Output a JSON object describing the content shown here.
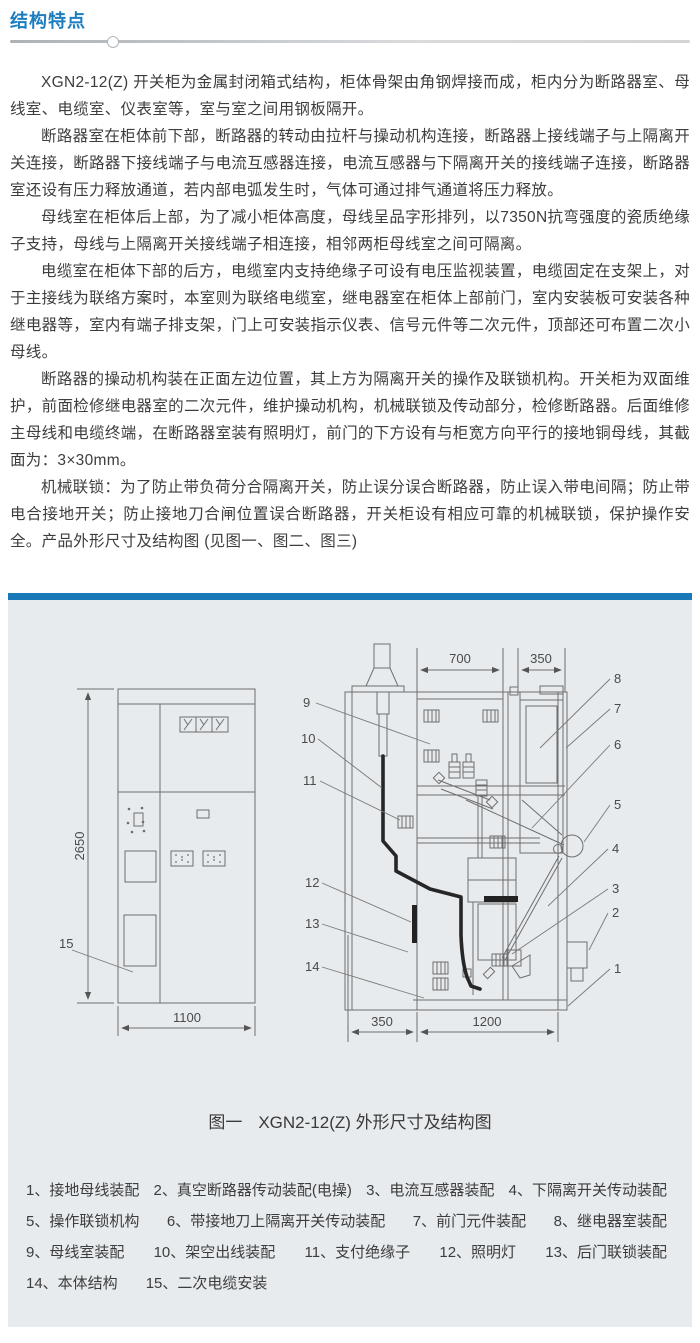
{
  "header": {
    "title": "结构特点"
  },
  "content": {
    "paragraphs": [
      "XGN2-12(Z) 开关柜为金属封闭箱式结构，柜体骨架由角钢焊接而成，柜内分为断路器室、母线室、电缆室、仪表室等，室与室之间用钢板隔开。",
      "断路器室在柜体前下部，断路器的转动由拉杆与操动机构连接，断路器上接线端子与上隔离开关连接，断路器下接线端子与电流互感器连接，电流互感器与下隔离开关的接线端子连接，断路器室还设有压力释放通道，若内部电弧发生时，气体可通过排气通道将压力释放。",
      "母线室在柜体后上部，为了减小柜体高度，母线呈品字形排列，以7350N抗弯强度的瓷质绝缘子支持，母线与上隔离开关接线端子相连接，相邻两柜母线室之间可隔离。",
      "电缆室在柜体下部的后方，电缆室内支持绝缘子可设有电压监视装置，电缆固定在支架上，对于主接线为联络方案时，本室则为联络电缆室，继电器室在柜体上部前门，室内安装板可安装各种继电器等，室内有端子排支架，门上可安装指示仪表、信号元件等二次元件，顶部还可布置二次小母线。",
      "断路器的操动机构装在正面左边位置，其上方为隔离开关的操作及联锁机构。开关柜为双面维护，前面检修继电器室的二次元件，维护操动机构，机械联锁及传动部分，检修断路器。后面维修主母线和电缆终端，在断路器室装有照明灯，前门的下方设有与柜宽方向平行的接地铜母线，其截面为：3×30mm。",
      "机械联锁：为了防止带负荷分合隔离开关，防止误分误合断路器，防止误入带电间隔；防止带电合接地开关；防止接地刀合闸位置误合断路器，开关柜设有相应可靠的机械联锁，保护操作安全。产品外形尺寸及结构图 (见图一、图二、图三)"
    ]
  },
  "figure": {
    "caption_label": "图一",
    "caption_title": "XGN2-12(Z) 外形尺寸及结构图",
    "dims": {
      "height": "2650",
      "width": "1100",
      "top_left": "700",
      "top_right": "350",
      "bottom_left": "350",
      "bottom_right": "1200"
    },
    "callouts": {
      "c1": "1",
      "c2": "2",
      "c3": "3",
      "c4": "4",
      "c5": "5",
      "c6": "6",
      "c7": "7",
      "c8": "8",
      "c9": "9",
      "c10": "10",
      "c11": "11",
      "c12": "12",
      "c13": "13",
      "c14": "14",
      "c15": "15"
    },
    "legend_rows": [
      [
        "1、接地母线装配",
        "2、真空断路器传动装配(电操)",
        "3、电流互感器装配",
        "4、下隔离开关传动装配"
      ],
      [
        "5、操作联锁机构",
        "6、带接地刀上隔离开关传动装配",
        "7、前门元件装配",
        "8、继电器室装配"
      ],
      [
        "9、母线室装配",
        "10、架空出线装配",
        "11、支付绝缘子",
        "12、照明灯",
        "13、后门联锁装配"
      ],
      [
        "14、本体结构",
        "15、二次电缆安装"
      ]
    ]
  },
  "colors": {
    "accent_blue": "#1c7dbf",
    "bar_blue": "#1878b8",
    "panel_bg": "#e7ebee",
    "text": "#3d3d3d"
  }
}
